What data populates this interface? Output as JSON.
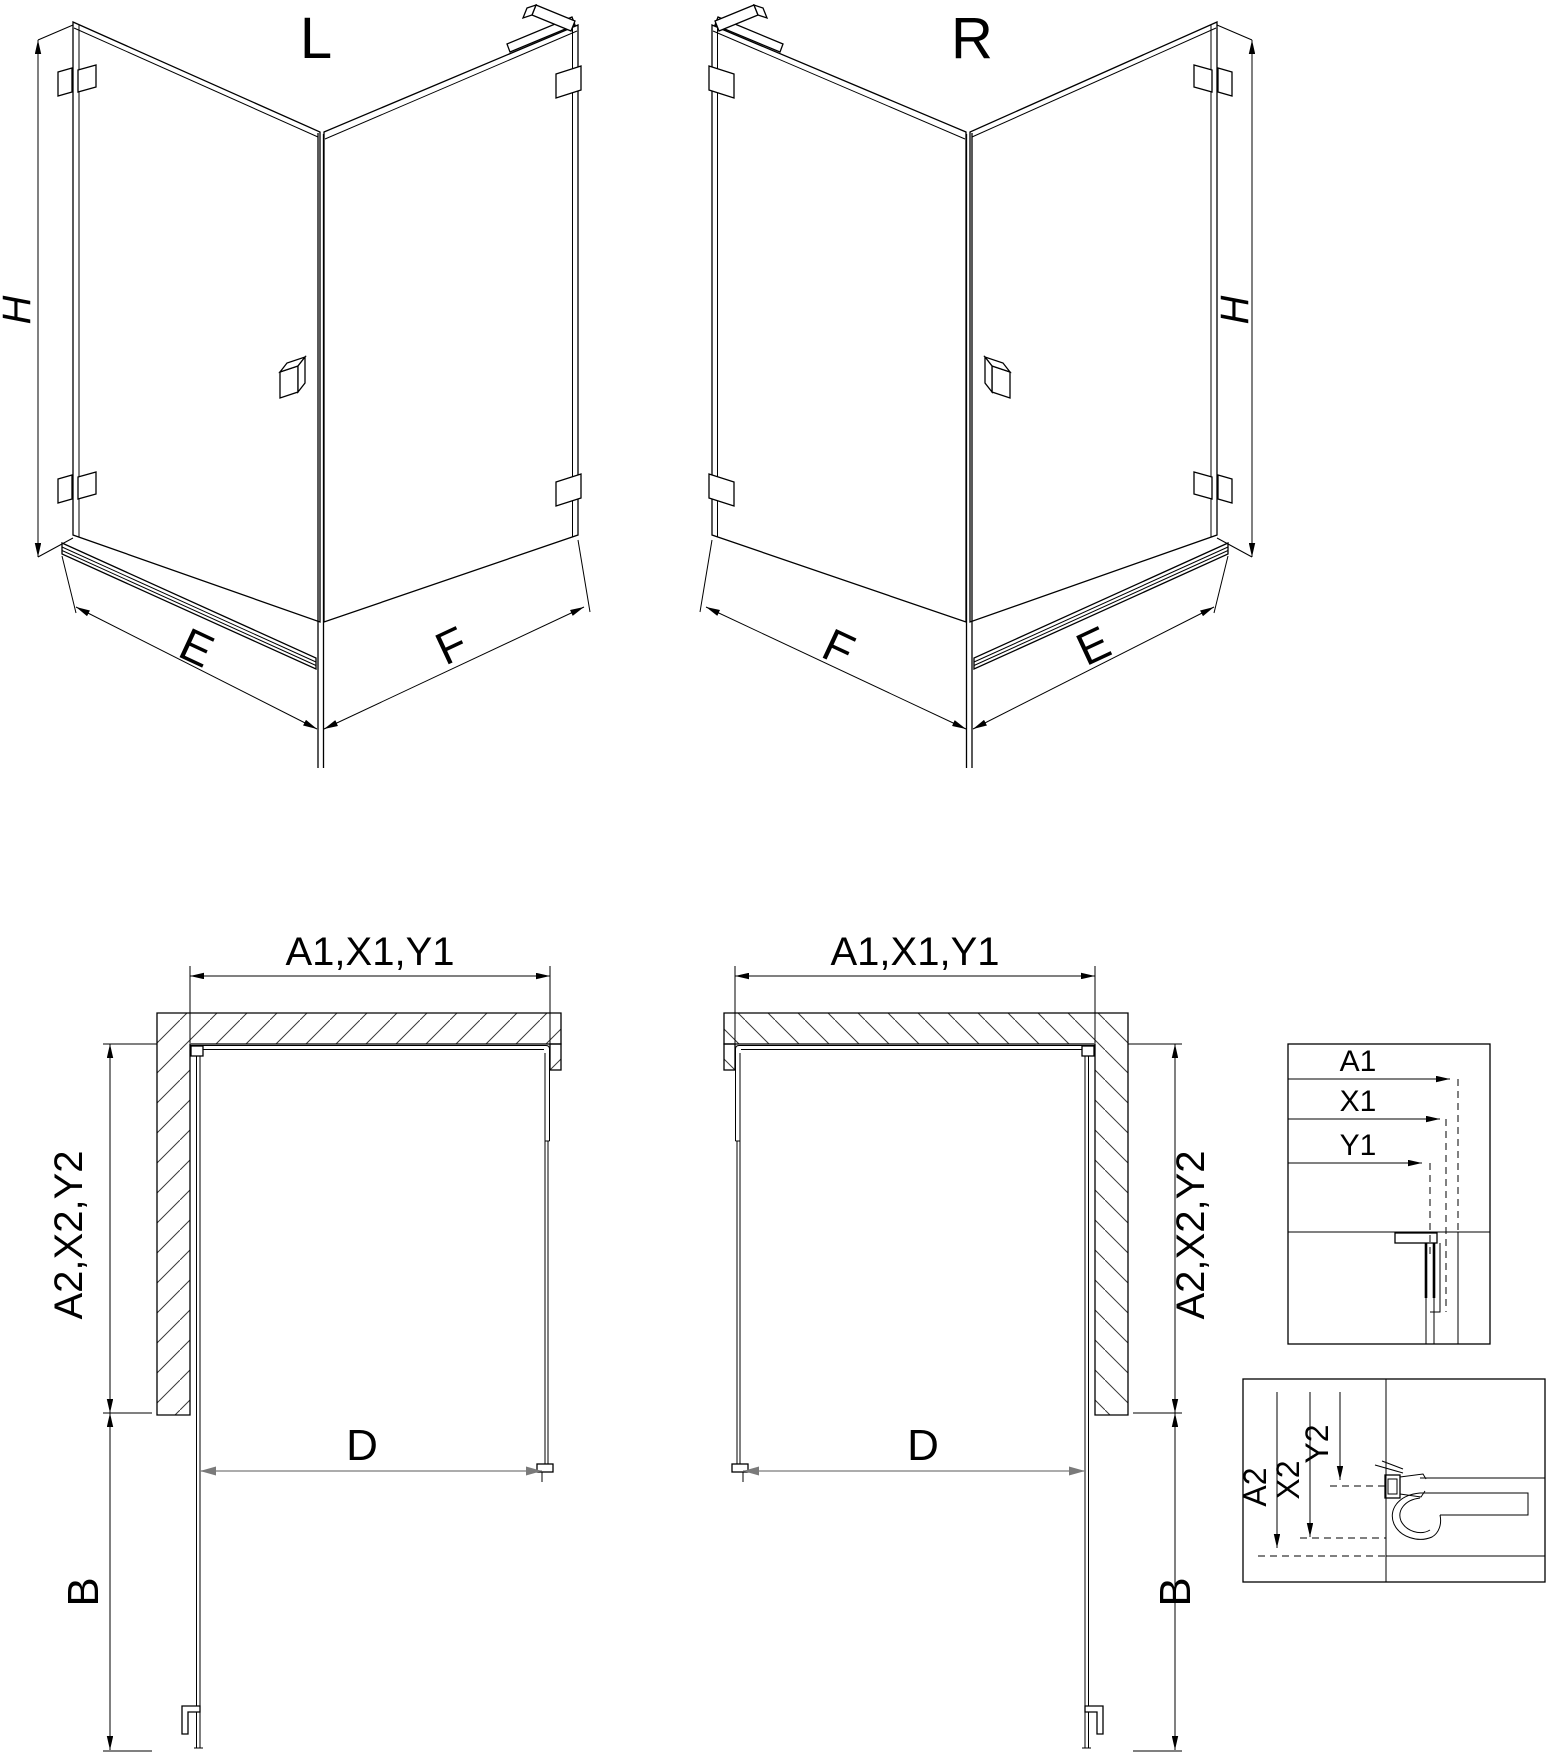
{
  "drawing": {
    "title_semantic": "shower-enclosure-technical-drawing",
    "colors": {
      "background": "#ffffff",
      "line": "#000000",
      "secondary_dim_line": "#7a7a7a"
    },
    "iso_left": {
      "variant_label": "L",
      "height_label": "H",
      "bottom_left_label": "E",
      "bottom_right_label": "F"
    },
    "iso_right": {
      "variant_label": "R",
      "height_label": "H",
      "bottom_left_label": "F",
      "bottom_right_label": "E"
    },
    "plan_left": {
      "width_label": "A1,X1,Y1",
      "depth_label": "A2,X2,Y2",
      "door_opening_label": "D",
      "door_projection_label": "B"
    },
    "plan_right": {
      "width_label": "A1,X1,Y1",
      "depth_label": "A2,X2,Y2",
      "door_opening_label": "D",
      "door_projection_label": "B"
    },
    "detail_top": {
      "labels": [
        "A1",
        "X1",
        "Y1"
      ]
    },
    "detail_bottom": {
      "labels": [
        "A2",
        "X2",
        "Y2"
      ]
    }
  }
}
